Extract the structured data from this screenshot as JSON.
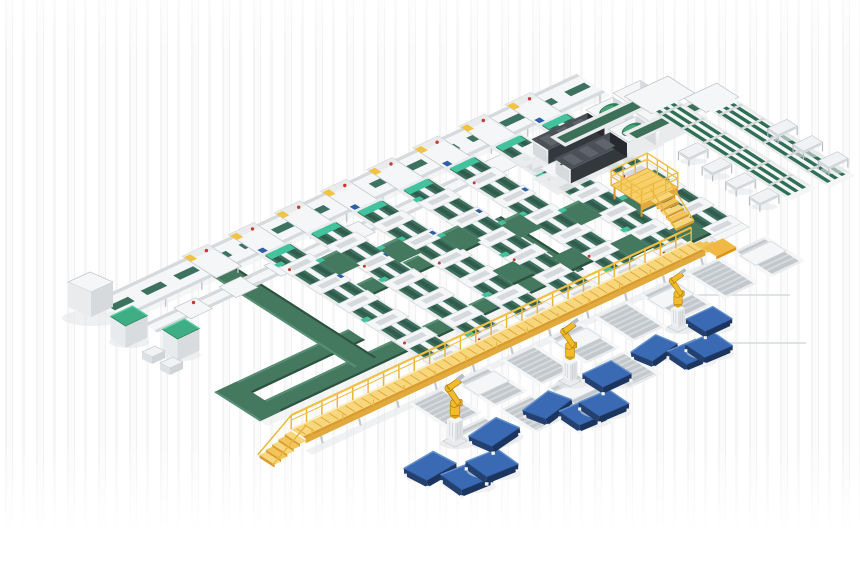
{
  "meta": {
    "description": "3D isometric render of an automated solar-module production and sorting line: parallel twin-belt conveyor lanes, cross transfer belts, inspection machines, an elevated yellow walkway with stairs, unloading robot arms and blue pallet stacks.",
    "visible_text": []
  },
  "palette": {
    "background": "#ffffff",
    "background_stripe": "#f3f3f4",
    "conveyor_green": "#45795f",
    "conveyor_green_dark": "#2d523f",
    "conveyor_green_light": "#578f74",
    "belt_green": "#3e7260",
    "belt_green_dark": "#315c4c",
    "teal_accent": "#43c29e",
    "frame_white": "#f4f6f7",
    "frame_light": "#e9ebec",
    "frame_mid": "#d6dadd",
    "frame_gray": "#c3c8cc",
    "frame_dark": "#b6bcc1",
    "walkway_yellow": "#f3c14d",
    "walkway_light": "#f8d77c",
    "walkway_pale": "#fdf0c8",
    "walkway_dark": "#d89b2f",
    "walkway_edge": "#e2a93c",
    "robot_yellow": "#f3bb2a",
    "robot_outline": "#a97b10",
    "pallet_blue": "#3a6ab4",
    "pallet_blue_light": "#6391cd",
    "pallet_blue_dark": "#23406f",
    "pallet_blue_side": "#1c355e",
    "machine_dark_top": "#4b5157",
    "machine_dark_front": "#33383d",
    "machine_dark_side": "#26292d",
    "machine_ridge": "#5d646b",
    "dome_green": "#2e7d5b",
    "dome_green_light": "#49a276",
    "cabinet_green": "#3fae84",
    "cabinet_green_dark": "#2e8763",
    "accent_red": "#c43b2e",
    "accent_blue": "#2f5fa8",
    "accent_yellow": "#f2c243",
    "shadow": "#e3e6e7",
    "shadow_soft": "#edefef"
  },
  "scene": {
    "components": [
      {
        "name": "stringer-lane",
        "label": "Twin-belt conveyor lane",
        "count": 7
      },
      {
        "name": "lane-head-station",
        "label": "Lane head station",
        "count": 8
      },
      {
        "name": "infeed-corridor",
        "label": "Cross infeed corridor",
        "count": 2
      },
      {
        "name": "return-loop-conveyor",
        "label": "Green return-loop conveyor",
        "count": 1
      },
      {
        "name": "transfer-shuttle",
        "label": "Green transfer belt",
        "count": 11
      },
      {
        "name": "inspection-machine",
        "label": "Dark inspection machine with green dome",
        "count": 2
      },
      {
        "name": "right-branch-conveyor",
        "label": "Right branch conveyor with benches",
        "count": 2
      },
      {
        "name": "side-bench",
        "label": "Side bench table",
        "count": 7
      },
      {
        "name": "maintenance-platform",
        "label": "Yellow maintenance platform with stairs",
        "count": 1
      },
      {
        "name": "walkway-gantry",
        "label": "Elevated yellow walkway with railing and stairs",
        "count": 1
      },
      {
        "name": "outfeed-roller",
        "label": "Outfeed roller conveyor",
        "count": 11
      },
      {
        "name": "unloading-robot",
        "label": "Yellow unloading robot arm",
        "count": 3
      },
      {
        "name": "pallet-stack",
        "label": "Blue pallet stack",
        "count": 12
      },
      {
        "name": "electrical-cabinet",
        "label": "Cabinet with green top",
        "count": 2
      },
      {
        "name": "infeed-cabinet",
        "label": "Gray infeed cabinet",
        "count": 1
      }
    ]
  }
}
